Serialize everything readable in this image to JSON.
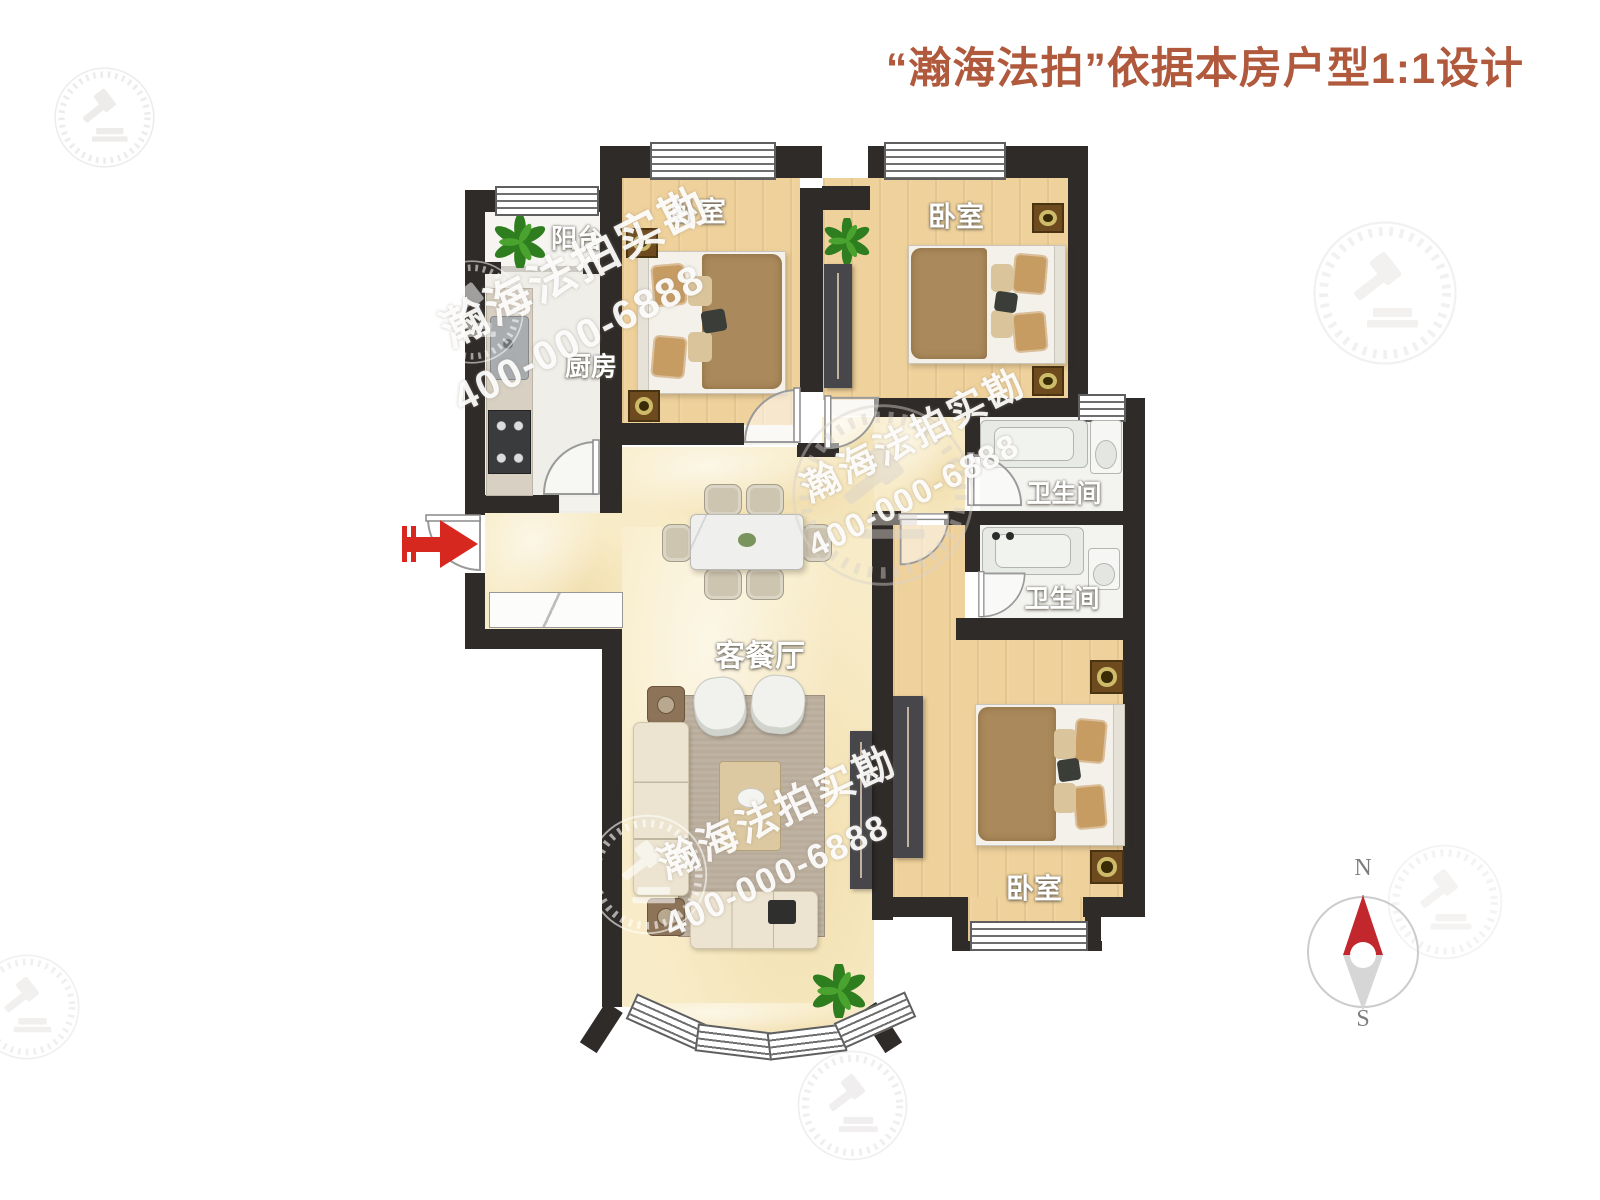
{
  "title": {
    "text": "“瀚海法拍”依据本房户型1:1设计"
  },
  "watermark": {
    "brand": "瀚海法拍实勘",
    "phone": "400-000-6888"
  },
  "rooms": {
    "balcony": {
      "label": "阳台"
    },
    "kitchen": {
      "label": "厨房"
    },
    "bedroom_top_left": {
      "label": "卧室"
    },
    "bedroom_top_right": {
      "label": "卧室"
    },
    "bedroom_bottom": {
      "label": "卧室"
    },
    "bathroom_upper": {
      "label": "卫生间"
    },
    "bathroom_lower": {
      "label": "卫生间"
    },
    "living_dining": {
      "label": "客餐厅"
    }
  },
  "compass": {
    "north": "N",
    "south": "S"
  },
  "colors": {
    "title_text": "#b0593c",
    "wall": "#2f2b29",
    "entry_arrow": "#d6281e",
    "compass_north": "#c1272d",
    "wood_floor": "#efd19b",
    "hall_floor": "#f8ecc8"
  }
}
